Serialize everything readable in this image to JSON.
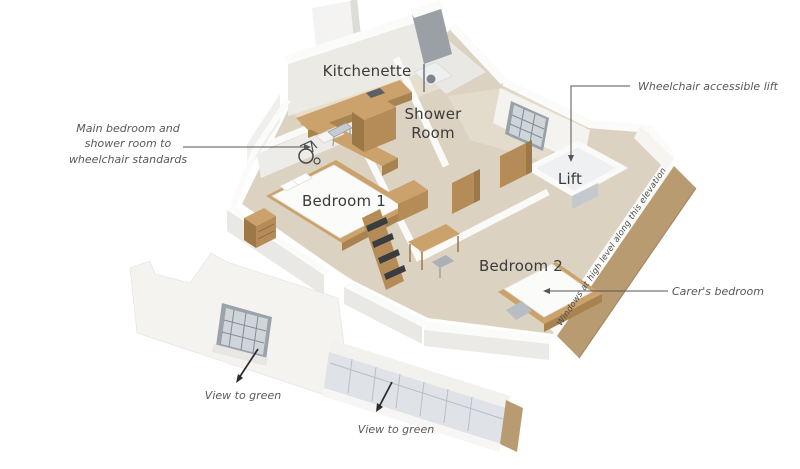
{
  "illustration": {
    "type": "isometric-cutaway-floor-plan",
    "colors": {
      "background": "#ffffff",
      "wall_white": "#fafaf8",
      "wall_face_light": "#efeeea",
      "wall_shade": "#c9cbce",
      "wall_dark_block": "#9aa0a6",
      "carpet": "#dcd2c2",
      "kitchen_floor": "#e7decd",
      "wood_light": "#cba26c",
      "wood_mid": "#b58c57",
      "wood_dark": "#9c7847",
      "cut_wall_tan": "#b99b72",
      "window_frame": "#98a1a8",
      "glazing": "#cfd6da",
      "leader_line": "#555555",
      "arrow_black": "#2b2b2b",
      "room_label_text": "#3b3b3b",
      "annotation_text": "#595959"
    }
  },
  "room_labels": [
    {
      "id": "kitchenette",
      "text": "Kitchenette"
    },
    {
      "id": "shower-room",
      "text": "Shower\nRoom"
    },
    {
      "id": "bedroom-1",
      "text": "Bedroom 1"
    },
    {
      "id": "lift",
      "text": "Lift"
    },
    {
      "id": "bedroom-2",
      "text": "Bedroom 2"
    }
  ],
  "annotations": [
    {
      "id": "wheelchair-standards",
      "text": "Main bedroom and\nshower room to\nwheelchair standards"
    },
    {
      "id": "wheelchair-lift",
      "text": "Wheelchair accessible lift"
    },
    {
      "id": "windows-high-level",
      "text": "Windows at high level along this elevation"
    },
    {
      "id": "carers-bedroom",
      "text": "Carer's bedroom"
    },
    {
      "id": "view-green-left",
      "text": "View to green"
    },
    {
      "id": "view-green-right",
      "text": "View to green"
    }
  ]
}
